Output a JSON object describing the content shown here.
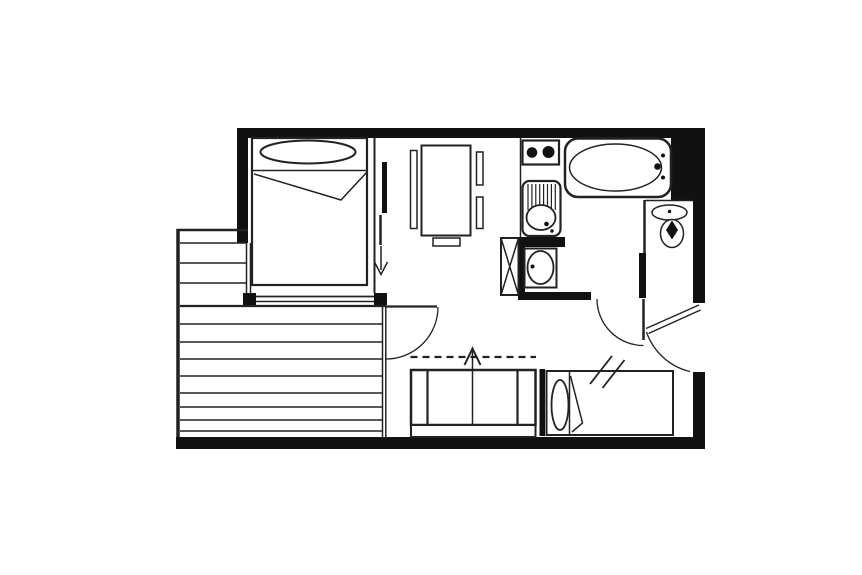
{
  "plan": {
    "kind": "studio-apartment-floor-plan",
    "colors": {
      "background": "#ffffff",
      "wall": "#111111",
      "line": "#222222"
    },
    "rooms": {
      "bedroom": "bedroom",
      "living_room": "living-room",
      "kitchenette": "kitchenette",
      "bathroom": "bathroom",
      "wc": "wc",
      "entrance_hall": "entrance-hall",
      "balcony": "balcony"
    },
    "labels": {
      "double_bed": "double-bed",
      "double_bed_pillow": "double-bed-pillow",
      "dining_table": "dining-table",
      "chair_left": "chair-left",
      "chair_right_top": "chair-right-top",
      "chair_right_bottom": "chair-right-bottom",
      "bench": "bench",
      "stove_hob": "two-burner-hob",
      "kitchen_sink": "kitchen-sink-with-drainboard",
      "bathtub": "bathtub",
      "storage_cabinet": "crossed-storage-cabinet",
      "washbasin": "washbasin",
      "toilet": "toilet",
      "sofa_bed": "convertible-sofa-bed",
      "single_bed": "single-bed",
      "balcony_decking": "balcony-decking-lines",
      "bedroom_sliding_door": "bedroom-sliding-door",
      "bedroom_entry_arrow": "arrow-down",
      "sofa_fold_arrow": "arrow-up",
      "balcony_door_swing": "balcony-door-swing",
      "bathroom_door_swing": "bathroom-door-swing",
      "entrance_door_swing": "entrance-door-swing",
      "window_slash_mark": "double-slash-mark"
    }
  }
}
